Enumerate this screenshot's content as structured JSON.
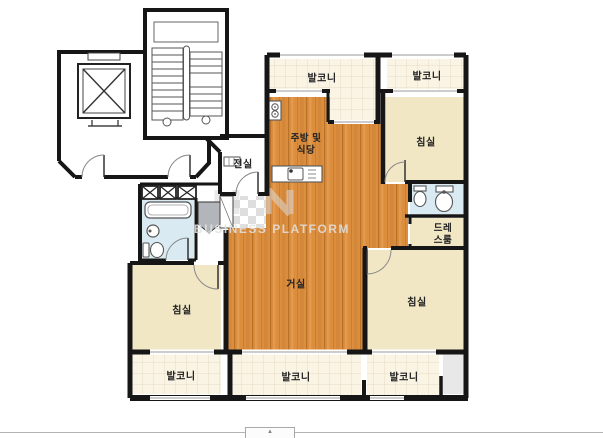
{
  "rooms": {
    "balcony_top_left": "발코니",
    "balcony_top_right": "발코니",
    "kitchen_line1": "주방 및",
    "kitchen_line2": "식당",
    "bedroom_top_right": "침실",
    "vestibule": "전실",
    "living": "거실",
    "dressroom_line1": "드레",
    "dressroom_line2": "스룸",
    "bedroom_bottom_right": "침실",
    "bedroom_bottom_left": "침실",
    "balcony_bottom_left": "발코니",
    "balcony_bottom_center": "발코니",
    "balcony_bottom_right": "발코니"
  },
  "watermark": {
    "text": "BUSINESS PLATFORM"
  },
  "bottom_bar": {
    "collapse_icon": "▲"
  },
  "colors": {
    "wall": "#161616",
    "wood_floor": "#dd8e3d",
    "bedroom_cream": "#f1e7c5",
    "balcony_tile": "#faf4e4",
    "bathroom_blue": "#d9eaf2",
    "ac_gray": "#e8e8e8",
    "divider_gray": "#b3b3b3"
  }
}
